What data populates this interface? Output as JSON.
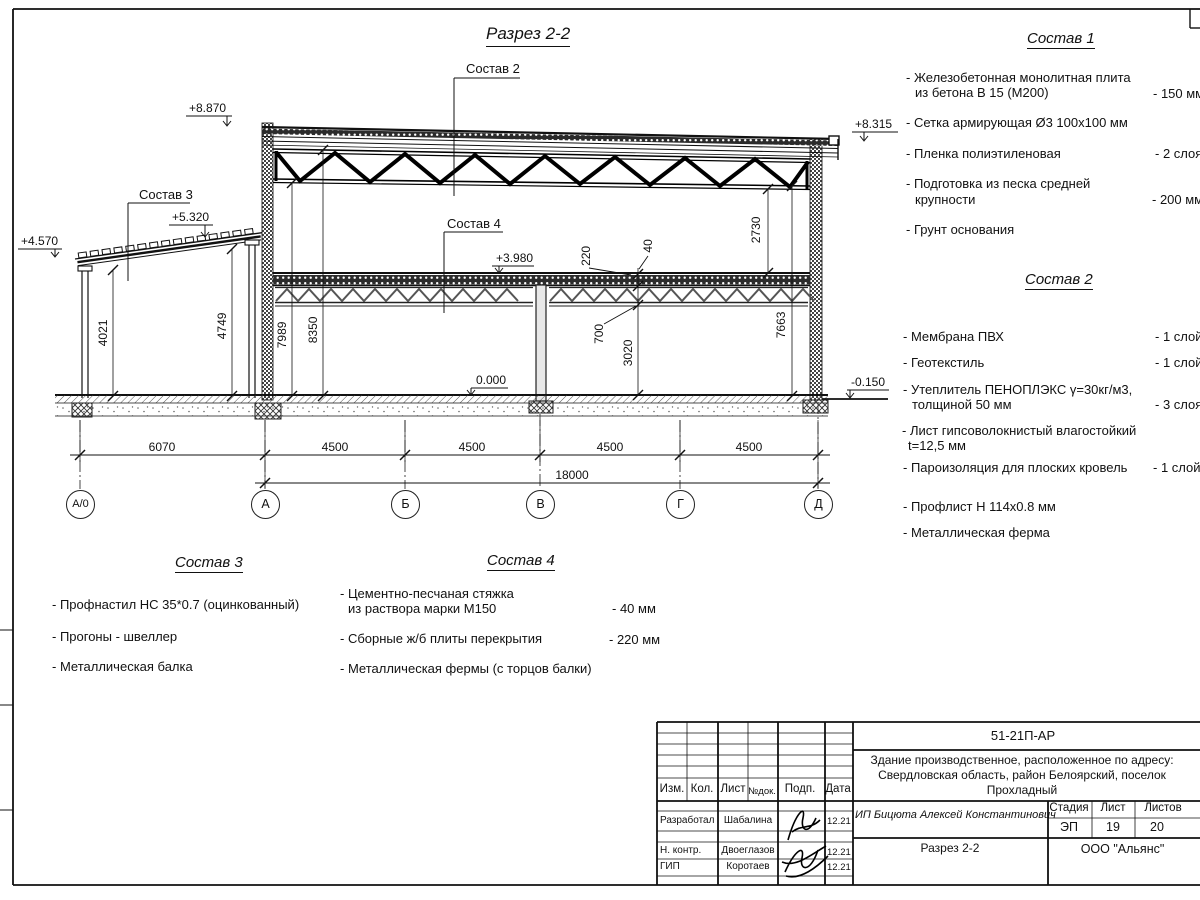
{
  "title": "Разрез 2-2",
  "section_labels": {
    "s2": "Состав 2",
    "s3": "Состав 3",
    "s4": "Состав 4"
  },
  "elevations": {
    "e8870": "+8.870",
    "e8315": "+8.315",
    "e4570": "+4.570",
    "e5320": "+5.320",
    "e3980": "+3.980",
    "e0000": "0.000",
    "em0150": "-0.150"
  },
  "dims": {
    "d4021": "4021",
    "d4749": "4749",
    "d7989": "7989",
    "d8350": "8350",
    "d2730": "2730",
    "d7663": "7663",
    "d220": "220",
    "d40": "40",
    "d700": "700",
    "d3020": "3020",
    "d6070": "6070",
    "d4500a": "4500",
    "d4500b": "4500",
    "d4500c": "4500",
    "d4500d": "4500",
    "d18000": "18000"
  },
  "axes": {
    "a0": "А/0",
    "a": "А",
    "b": "Б",
    "v": "В",
    "g": "Г",
    "d": "Д"
  },
  "sostav1": {
    "title": "Состав 1",
    "i1a": "- Железобетонная  монолитная плита",
    "i1b": "из бетона В 15 (М200)",
    "i1v": "- 150 мм",
    "i2a": "- Сетка армирующая Ø3 100х100 мм",
    "i3a": "- Пленка полиэтиленовая",
    "i3v": "-  2 слоя",
    "i4a": "- Подготовка из песка средней",
    "i4b": "крупности",
    "i4v": "- 200 мм",
    "i5a": "- Грунт основания"
  },
  "sostav2": {
    "title": "Состав 2",
    "i1a": "- Мембрана ПВХ",
    "i1v": "- 1 слой",
    "i2a": "- Геотекстиль",
    "i2v": "- 1 слой",
    "i3a": "- Утеплитель ПЕНОПЛЭКС γ=30кг/м3,",
    "i3b": "толщиной 50 мм",
    "i3v": "- 3 слоя",
    "i4a": "- Лист гипсоволокнистый влагостойкий",
    "i4b": "t=12,5 мм",
    "i5a": "- Пароизоляция для плоских кровель",
    "i5v": "- 1 слой",
    "i6a": "- Профлист Н 114х0.8 мм",
    "i7a": "- Металлическая ферма"
  },
  "sostav3": {
    "title": "Состав 3",
    "i1": "- Профнастил НС 35*0.7 (оцинкованный)",
    "i2": "- Прогоны - швеллер",
    "i3": "- Металлическая балка"
  },
  "sostav4": {
    "title": "Состав 4",
    "i1a": "- Цементно-песчаная стяжка",
    "i1b": "из раствора марки М150",
    "i1v": "- 40 мм",
    "i2a": "- Сборные ж/б плиты перекрытия",
    "i2v": "- 220 мм",
    "i3a": "- Металлическая фермы (с торцов балки)"
  },
  "stamp": {
    "doc_number": "51-21П-АР",
    "object_name_1": "Здание производственное, расположенное по адресу:",
    "object_name_2": "Свердловская область, район Белоярский, поселок",
    "object_name_3": "Прохладный",
    "client": "ИП Бицюта Алексей Константинович",
    "col_izm": "Изм.",
    "col_kol": "Кол.",
    "col_list": "Лист",
    "col_ndok": "№док.",
    "col_podp": "Подп.",
    "col_data": "Дата",
    "row1_role": "Разработал",
    "row1_name": "Шабалина",
    "row1_date": "12.21",
    "row2_role": "Н. контр.",
    "row2_name": "Двоеглазов",
    "row2_date": "12.21",
    "row3_role": "ГИП",
    "row3_name": "Коротаев",
    "row3_date": "12.21",
    "stage_label": "Стадия",
    "sheet_label": "Лист",
    "sheets_label": "Листов",
    "stage": "ЭП",
    "sheet": "19",
    "sheets": "20",
    "drawing_name": "Разрез 2-2",
    "company": "ООО \"Альянс\""
  }
}
